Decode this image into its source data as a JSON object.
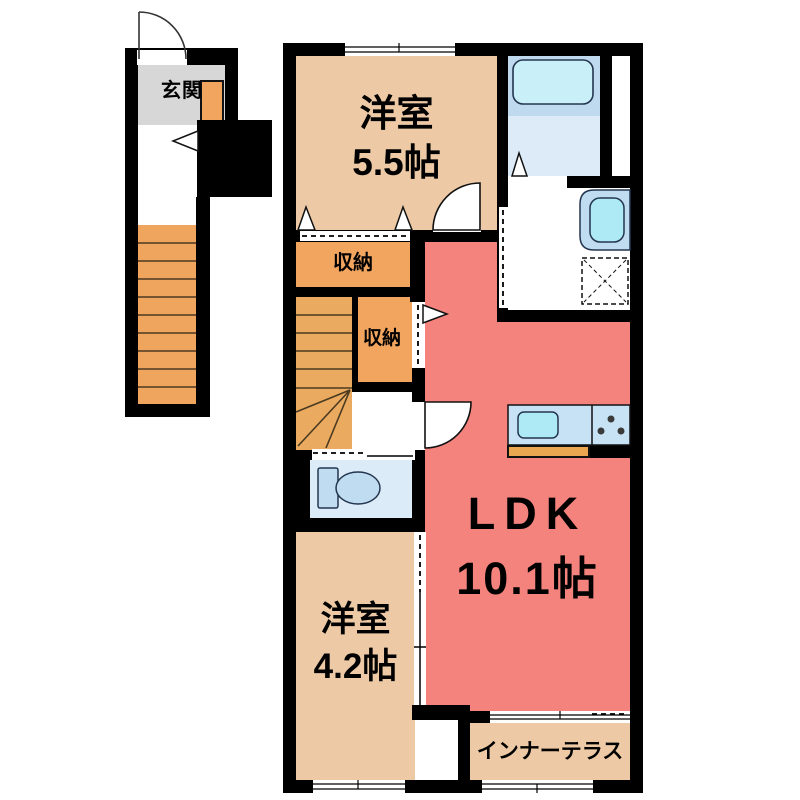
{
  "floor_plan": {
    "rooms": {
      "genkan": {
        "label": "玄関"
      },
      "entrance_closet": {
        "label": "収納"
      },
      "bedroom_upper": {
        "type": "洋室",
        "size": "5.5帖"
      },
      "upper_closet": {
        "label": "収納"
      },
      "lower_closet": {
        "label": "収納"
      },
      "ldk": {
        "type": "LDK",
        "size": "10.1帖"
      },
      "bedroom_lower": {
        "type": "洋室",
        "size": "4.2帖"
      },
      "inner_terrace": {
        "label": "インナーテラス"
      }
    },
    "colors": {
      "wall": "#000000",
      "bedroom_floor": "#edcaa5",
      "ldk_floor": "#f5837d",
      "closet_floor": "#f2a55f",
      "outdoor_stairs_floor": "#f0a55e",
      "indoor_stairs_floor": "#eaaa60",
      "genkan_floor": "#d7d7d7",
      "bathroom_floor": "#bfd9ee",
      "bathroom_lower_floor": "#dcebf7",
      "toilet_floor": "#dcebf8",
      "bathtub_fill": "#c9f0f9",
      "kitchen_counter_fill": "#c6e2f4",
      "sink_fill": "#aee9f6"
    },
    "icons": {
      "bathtub": "bathtub-icon",
      "toilet": "toilet-icon",
      "wash_basin": "sink-icon",
      "washing_machine": "washing-machine-icon",
      "stove": "stove-icon",
      "kitchen_sink": "kitchen-sink-icon",
      "door_arc": "door-arc-icon",
      "direction_arrow": "direction-arrow-icon"
    }
  }
}
